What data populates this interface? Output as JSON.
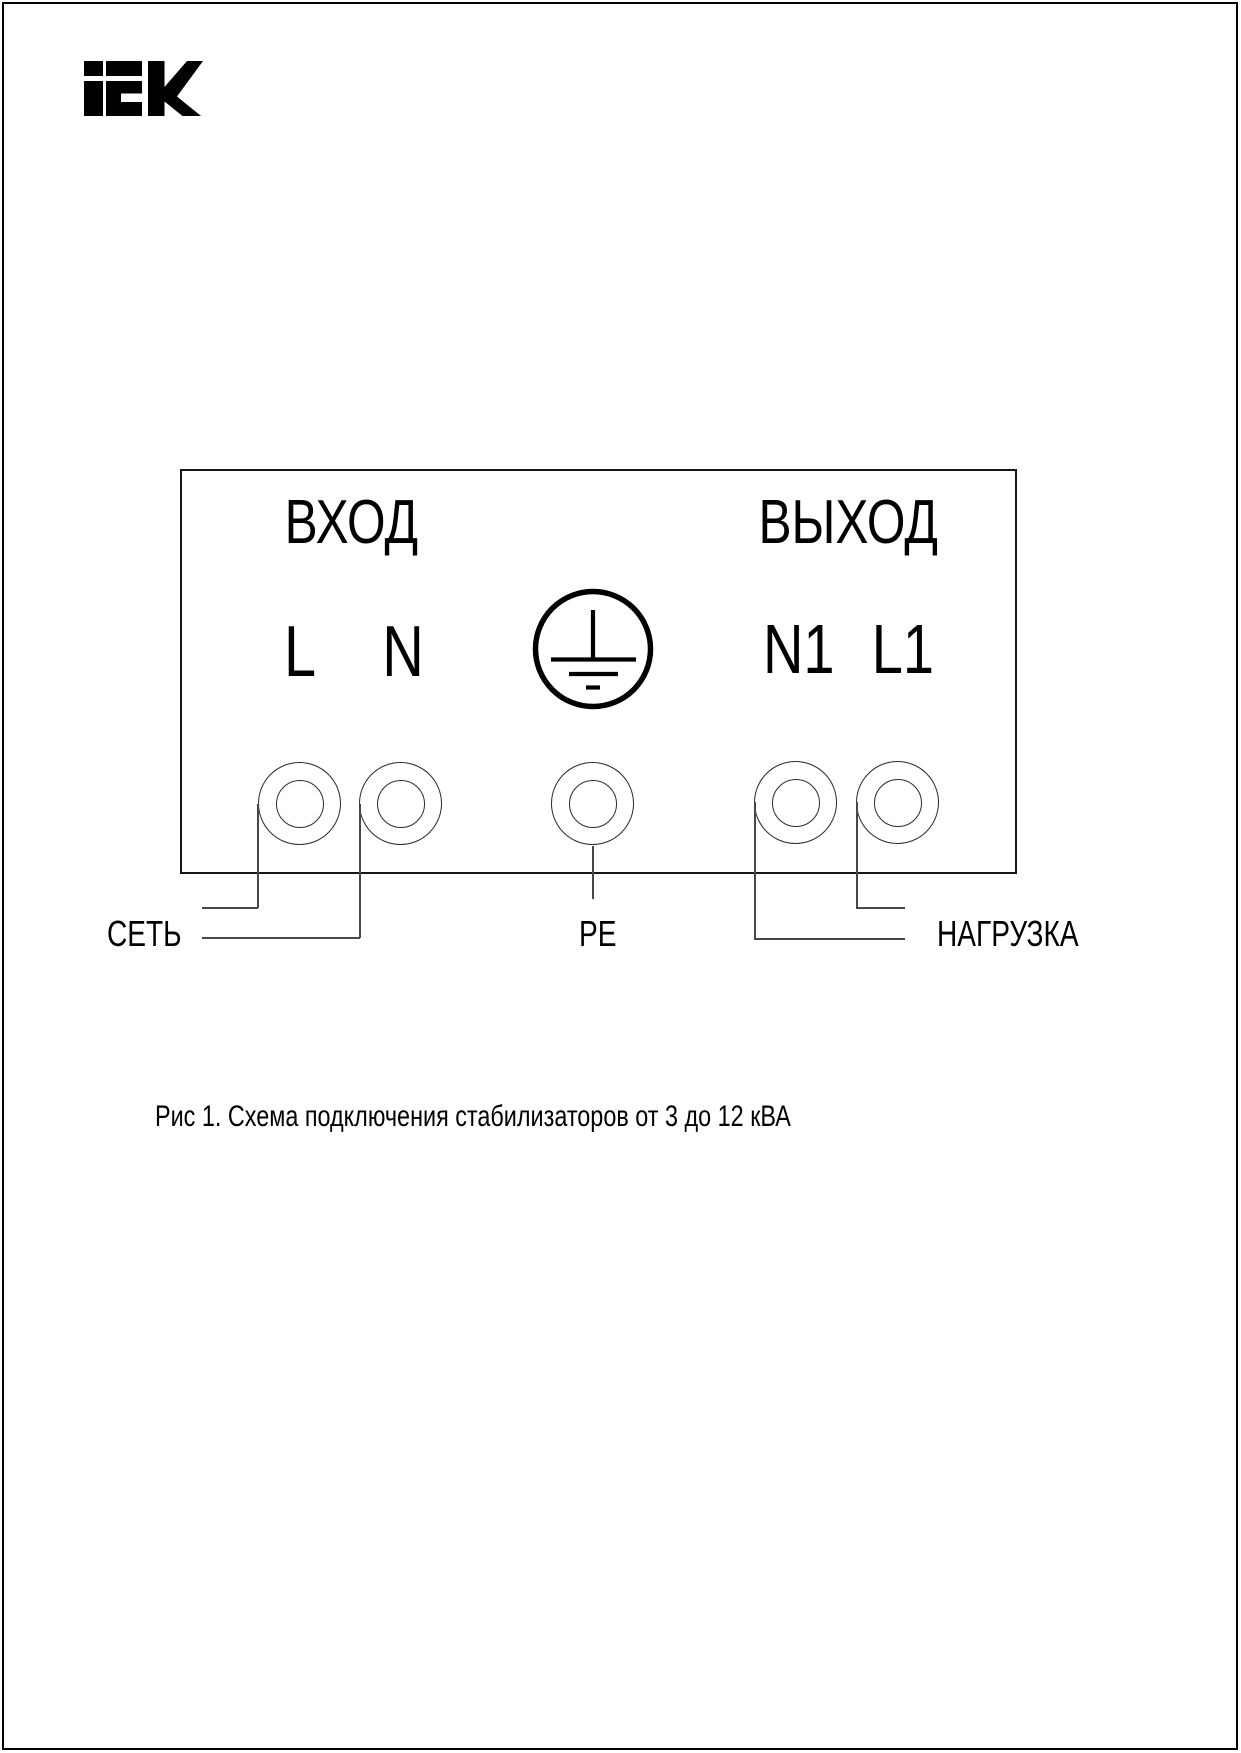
{
  "logo": {
    "alt": "IEK"
  },
  "diagram": {
    "input_section_label": "ВХОД",
    "output_section_label": "ВЫХОД",
    "terminals": {
      "l": "L",
      "n": "N",
      "n1": "N1",
      "l1": "L1"
    },
    "wire_labels": {
      "mains": "СЕТЬ",
      "earth": "PE",
      "load": "НАГРУЗКА"
    }
  },
  "caption": "Рис 1. Схема подключения стабилизаторов от 3 до 12 кВА",
  "colors": {
    "ink": "#000000",
    "wire": "#474747",
    "background": "#ffffff"
  }
}
